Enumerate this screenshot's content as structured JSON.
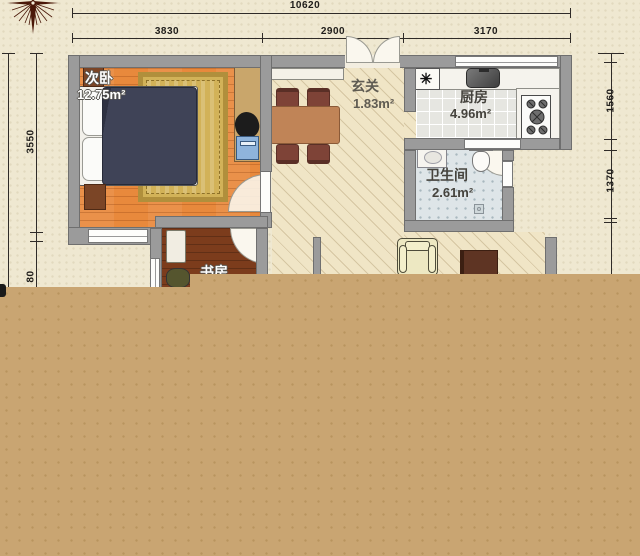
{
  "meta": {
    "type": "apartment-floor-plan"
  },
  "compass": {
    "icon": "compass-rose"
  },
  "dims": {
    "total": "10620",
    "top": [
      "3830",
      "2900",
      "3170"
    ],
    "left": [
      "3550",
      "80"
    ],
    "right": [
      "1560",
      "1370"
    ]
  },
  "rooms": {
    "bedroom": {
      "label": "次卧",
      "area": "12.75m²"
    },
    "entry": {
      "label": "玄关",
      "area": "1.83m²"
    },
    "kitchen": {
      "label": "厨房",
      "area": "4.96m²"
    },
    "bath": {
      "label": "卫生间",
      "area": "2.61m²"
    },
    "study": {
      "label": "书房"
    }
  },
  "symbols": {
    "appliance_marker": "✳"
  },
  "colors": {
    "paper": "#EFE8D1",
    "overlay": "#C9A572",
    "wall": "#9B9B9B",
    "bedroom_floor": "#E8893C",
    "study_floor": "#7C3C1C",
    "duvet": "#3F4357",
    "rug": "#D2B258"
  }
}
